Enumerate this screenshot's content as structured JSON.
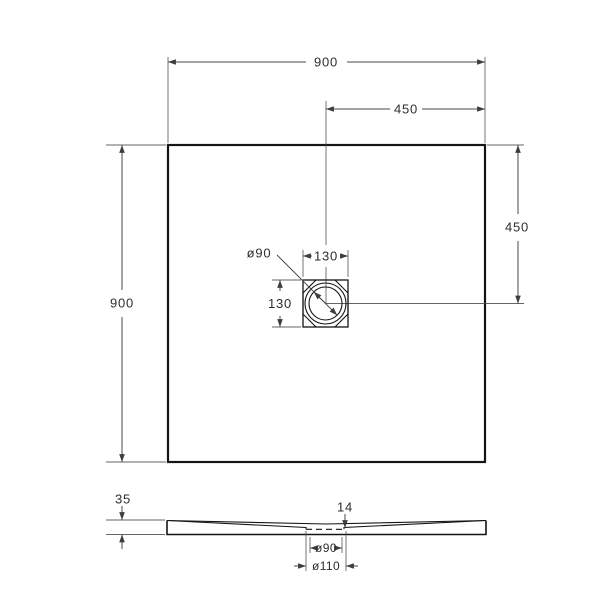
{
  "drawing_type": "technical-dimension-drawing",
  "views": {
    "plan": {
      "width_label": "900",
      "half_width_label": "450",
      "height_label": "900",
      "half_height_label": "450",
      "drain": {
        "diameter_label": "ø90",
        "box_width_label": "130",
        "box_height_label": "130"
      }
    },
    "section": {
      "thickness_label": "35",
      "waste_offset_label": "14",
      "drain_hole_label": "ø90",
      "flange_label": "ø110"
    }
  },
  "colors": {
    "background": "#ffffff",
    "outline": "#141414",
    "line": "#4a4a4a",
    "text": "#2e2e2e"
  }
}
